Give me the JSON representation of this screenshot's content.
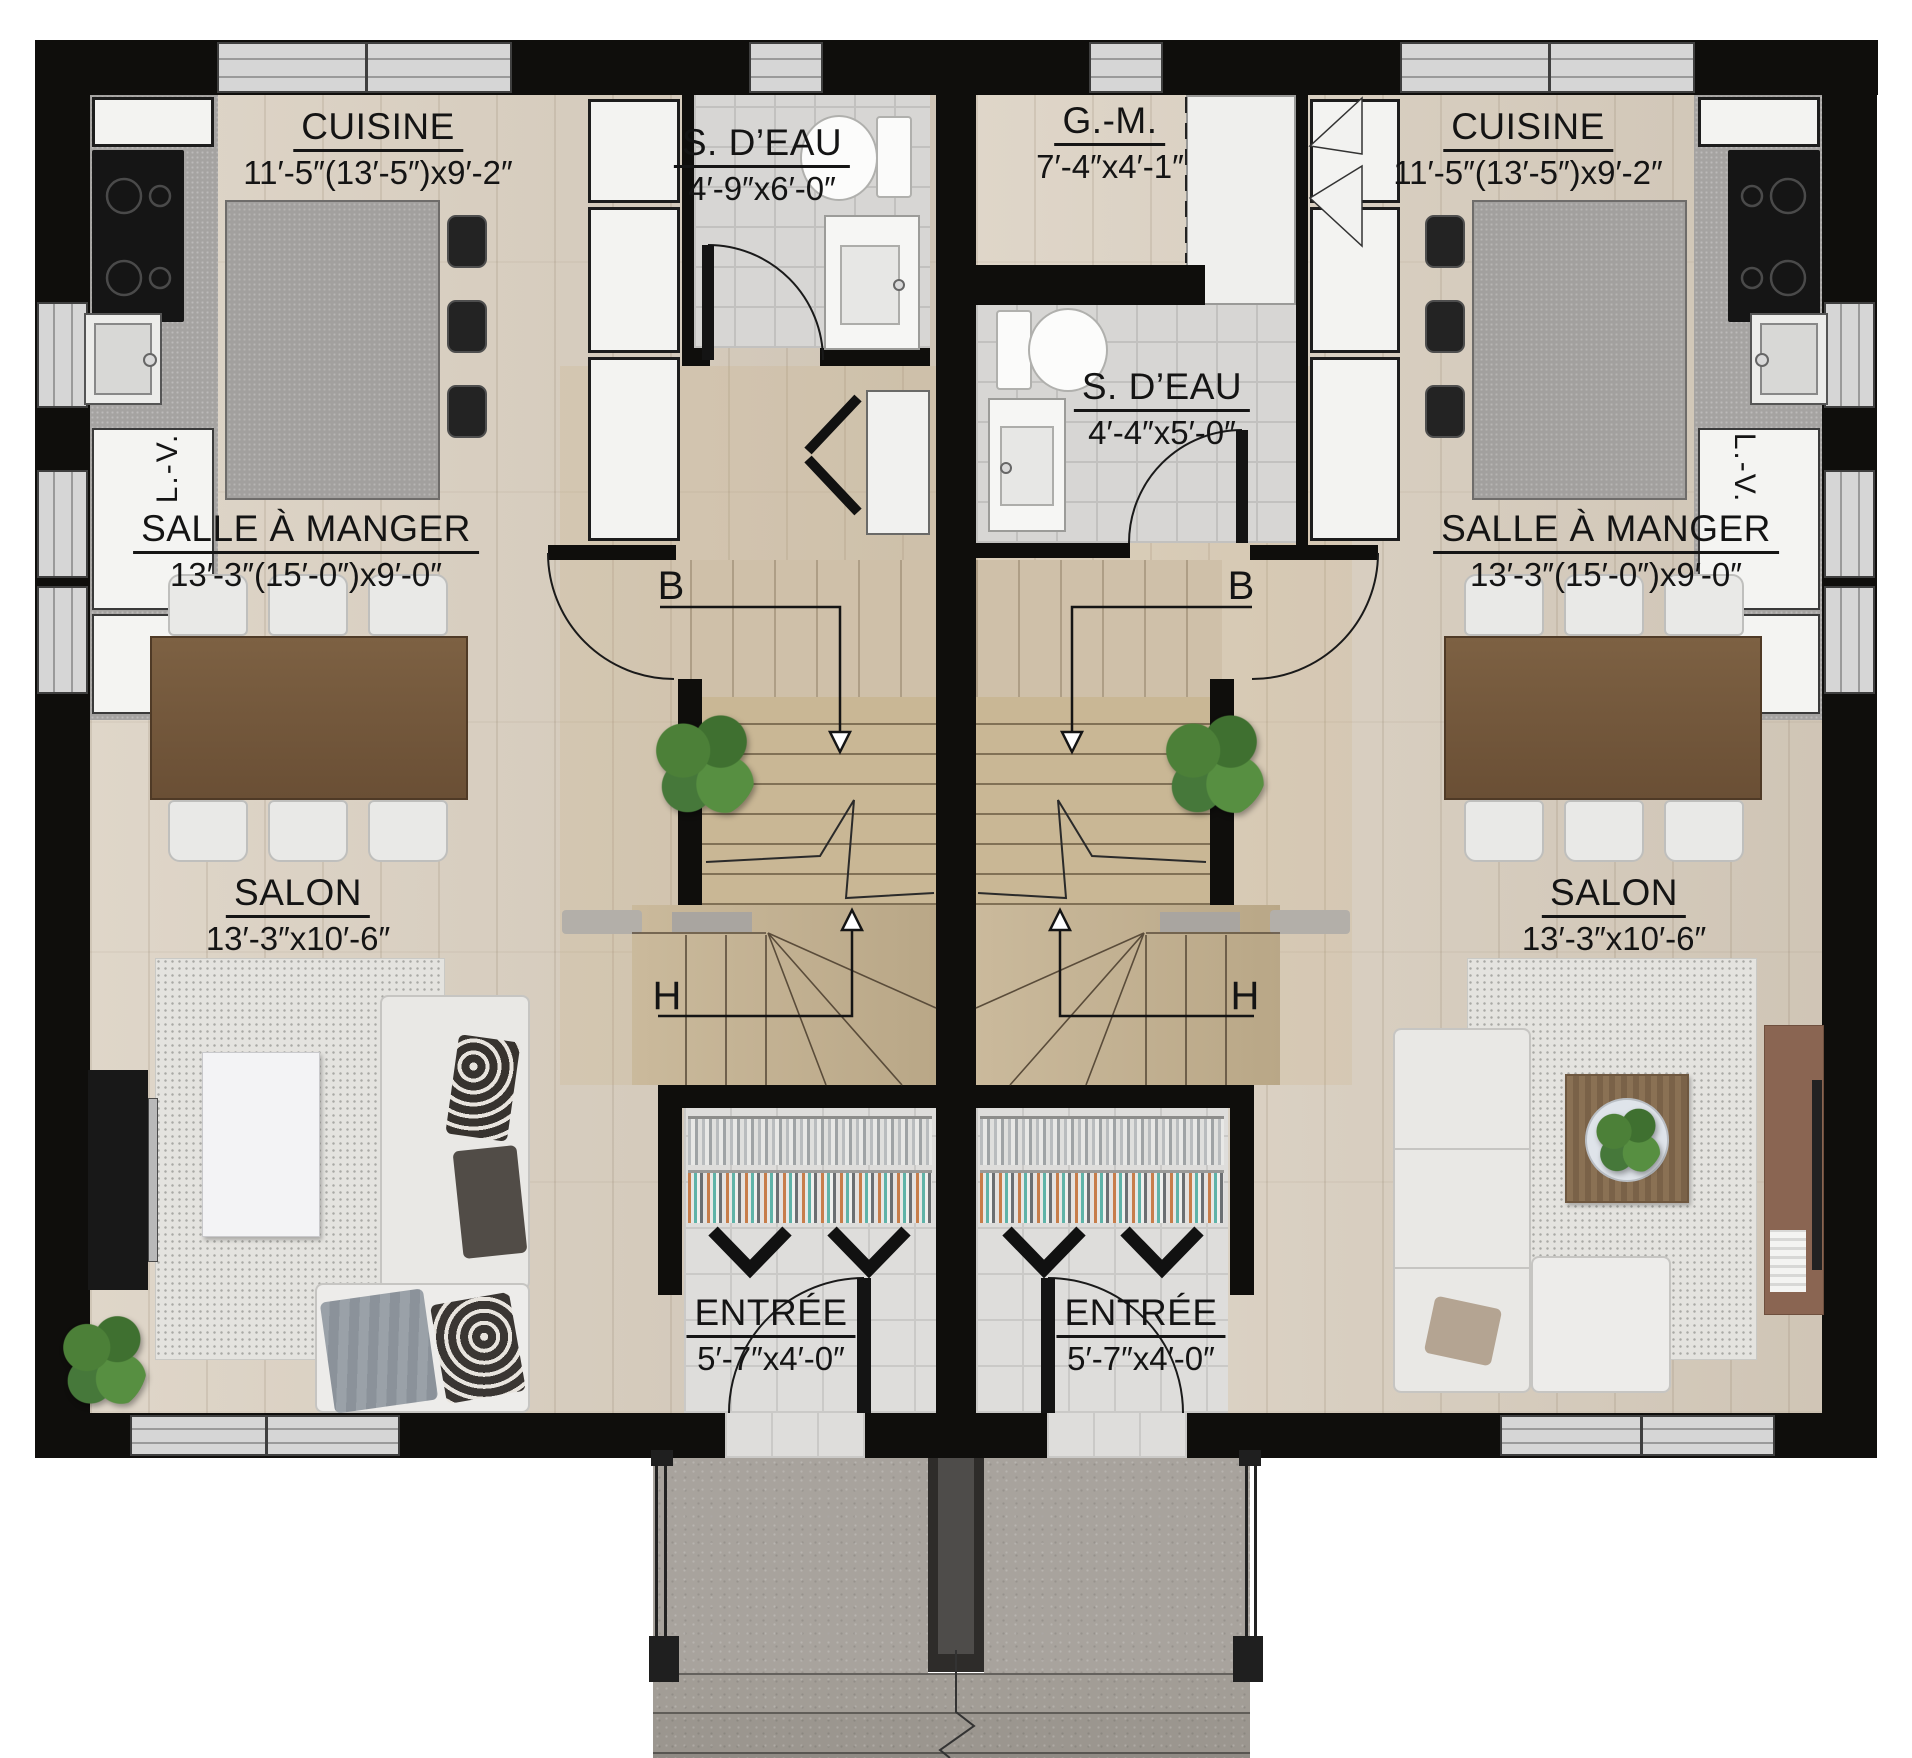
{
  "plan": {
    "stair_markers": {
      "down": "B",
      "up": "H"
    },
    "left_unit": {
      "cuisine": {
        "name": "CUISINE",
        "dims": "11′-5″(13′-5″)x9′-2″"
      },
      "s_deau": {
        "name": "S. D’EAU",
        "dims": "4′-9″x6′-0″"
      },
      "salle_a_manger": {
        "name": "SALLE À MANGER",
        "dims": "13′-3″(15′-0″)x9′-0″"
      },
      "salon": {
        "name": "SALON",
        "dims": "13′-3″x10′-6″"
      },
      "entree": {
        "name": "ENTRÉE",
        "dims": "5′-7″x4′-0″"
      },
      "lave_vaisselle": "L.-V."
    },
    "right_unit": {
      "garde_manger": {
        "name": "G.-M.",
        "dims": "7′-4″x4′-1″"
      },
      "cuisine": {
        "name": "CUISINE",
        "dims": "11′-5″(13′-5″)x9′-2″"
      },
      "s_deau": {
        "name": "S. D’EAU",
        "dims": "4′-4″x5′-0″"
      },
      "salle_a_manger": {
        "name": "SALLE À MANGER",
        "dims": "13′-3″(15′-0″)x9′-0″"
      },
      "salon": {
        "name": "SALON",
        "dims": "13′-3″x10′-6″"
      },
      "entree": {
        "name": "ENTRÉE",
        "dims": "5′-7″x4′-0″"
      },
      "lave_vaisselle": "L.-V."
    },
    "colors": {
      "wall": "#0f0e0c",
      "wood_floor": "#d8cdbd",
      "stair_wood": "#c9b795",
      "tile": "#d7d6d4",
      "counter": "#a5a3a1",
      "dining_table": "#7d6143",
      "sofa": "#e9e8e5",
      "rug": "#e4e3df",
      "concrete": "#a8a39d",
      "plant_green": "#4c8038",
      "text": "#141414"
    }
  }
}
